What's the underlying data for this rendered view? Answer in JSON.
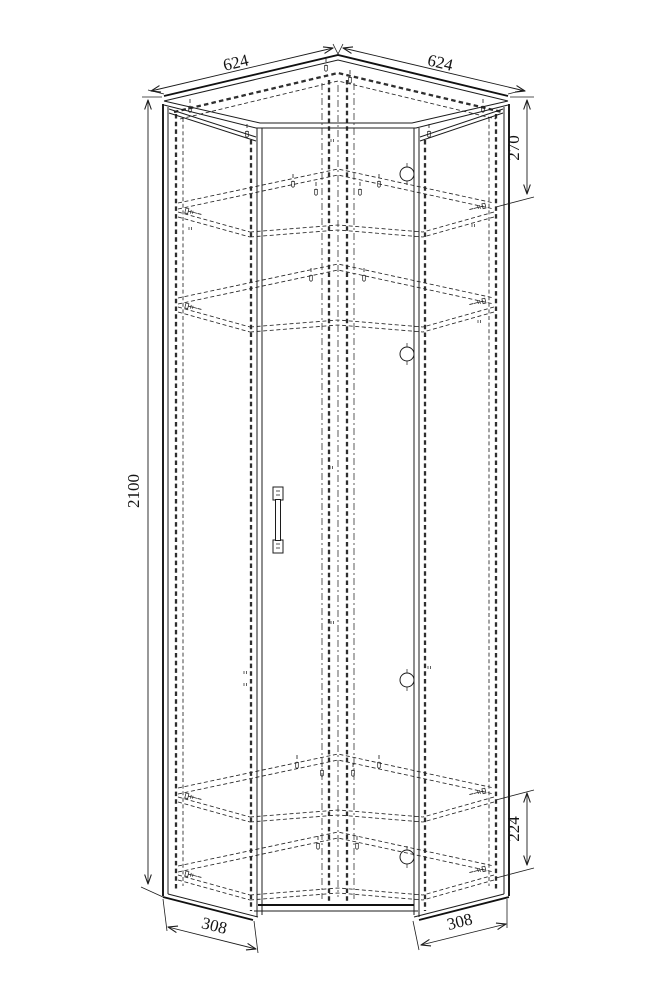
{
  "colors": {
    "background": "#ffffff",
    "line": "#1c1c1c",
    "hidden_line": "#2e2e2e"
  },
  "drawing": {
    "kind": "corner-wardrobe-assembly-drawing"
  },
  "dimensions": {
    "top_edge_left": "624",
    "top_edge_right": "624",
    "overall_height": "2100",
    "top_shelf_offset": "270",
    "bottom_shelf_gap": "224",
    "side_depth_left": "308",
    "side_depth_right": "308"
  }
}
